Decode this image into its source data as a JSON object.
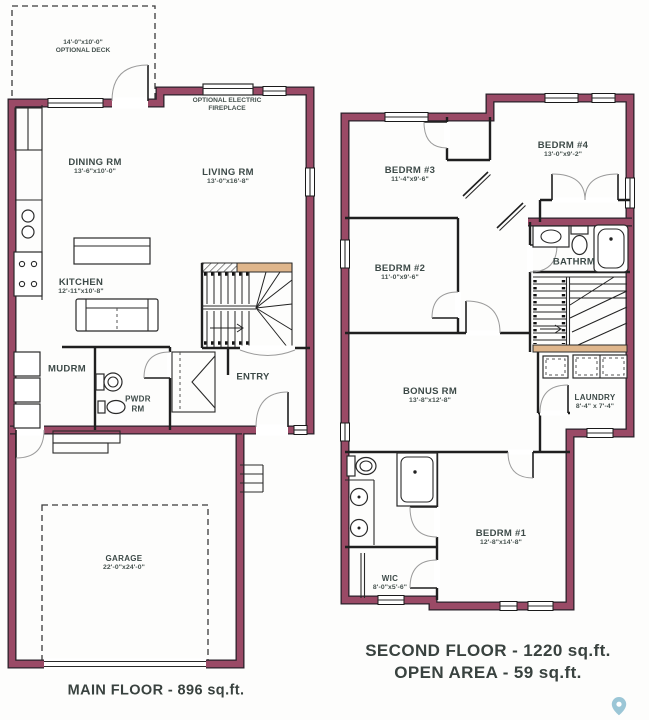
{
  "main_floor": {
    "caption": "MAIN FLOOR - 896 sq.ft.",
    "deck": {
      "dims": "14'-0\"x10'-0\"",
      "name": "OPTIONAL DECK"
    },
    "fireplace": {
      "line1": "OPTIONAL ELECTRIC",
      "line2": "FIREPLACE"
    },
    "dining": {
      "name": "DINING RM",
      "dims": "13'-6\"x10'-0\""
    },
    "living": {
      "name": "LIVING RM",
      "dims": "13'-0\"x16'-8\""
    },
    "kitchen": {
      "name": "KITCHEN",
      "dims": "12'-11\"x10'-8\""
    },
    "mudroom": {
      "name": "MUDRM"
    },
    "powder": {
      "line1": "PWDR",
      "line2": "RM"
    },
    "entry": {
      "name": "ENTRY"
    },
    "garage": {
      "name": "GARAGE",
      "dims": "22'-0\"x24'-0\""
    }
  },
  "second_floor": {
    "caption_area": "SECOND FLOOR - 1220 sq.ft.",
    "caption_open": "OPEN AREA - 59 sq.ft.",
    "bedrm3": {
      "name": "BEDRM #3",
      "dims": "11'-4\"x9'-6\""
    },
    "bedrm4": {
      "name": "BEDRM #4",
      "dims": "13'-0\"x9'-2\""
    },
    "bedrm2": {
      "name": "BEDRM #2",
      "dims": "11'-0\"x9'-6\""
    },
    "bathrm": {
      "name": "BATHRM"
    },
    "bonus": {
      "name": "BONUS RM",
      "dims": "13'-8\"x12'-8\""
    },
    "laundry": {
      "name": "LAUNDRY",
      "dims": "8'-4\" x 7'-4\""
    },
    "bedrm1": {
      "name": "BEDRM #1",
      "dims": "12'-8\"x14'-8\""
    },
    "wic": {
      "name": "WIC",
      "dims": "8'-0\"x5'-6\""
    }
  },
  "colors": {
    "wall": "#9a4a66",
    "landing": "#dfb68c",
    "pin": "#8abccf",
    "text": "#3d4a48"
  }
}
